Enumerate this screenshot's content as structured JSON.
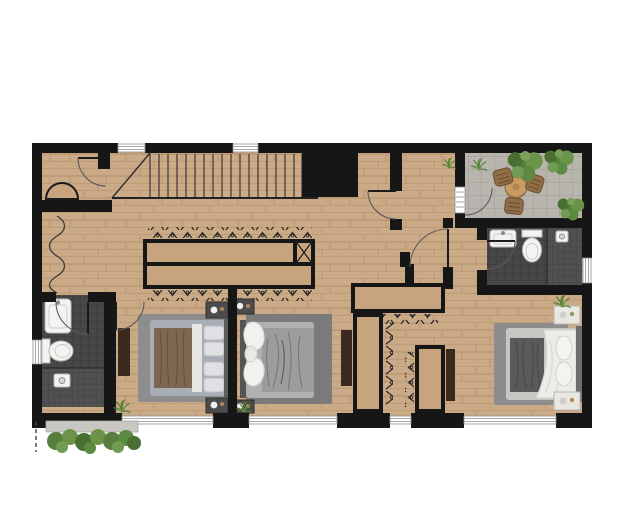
{
  "meta": {
    "title": "upper-floor-architectural-plan",
    "canvas": {
      "width": 623,
      "height": 532
    },
    "visible_text": []
  },
  "palette": {
    "wall": "#161616",
    "wood_floor": "#cbaa87",
    "wood_line": "#bb9671",
    "wardrobe_wood": "#c8a47e",
    "terrace_tile": "#b7b5ae",
    "bath_tile": "#474747",
    "shower_tile": "#515151",
    "rug": "#8d8d8d",
    "rug_mid": "#7b7b7b",
    "dresser": "#3b2a1d",
    "bed_brown": "#7c6750",
    "bed_gray": "#9c9c9c",
    "linen_white": "#edece8",
    "plant_green": "#4e7d33",
    "outside_ledge": "#c9c7c2",
    "window_frame": "#8f8f8f",
    "table_wood": "#c99b62",
    "chair_wicker": "#8f6d46"
  },
  "rooms": [
    {
      "name": "stair-hall",
      "features": [
        "staircase-18-treads",
        "storage-closet-top-left",
        "hanging-closet-wavy-symbol"
      ]
    },
    {
      "name": "hallway",
      "features": [
        "double-sided-wardrobe-with-hangers",
        "shaft-x-square"
      ]
    },
    {
      "name": "terrace",
      "features": [
        "round-table",
        "three-wicker-chairs",
        "corner-bushes",
        "stone-tile-floor",
        "glass-door"
      ]
    },
    {
      "name": "bathroom-ensuite-top-right",
      "fixtures": [
        "vanity-sink",
        "toilet",
        "shower"
      ],
      "features": [
        "window-right-wall"
      ]
    },
    {
      "name": "bathroom-left",
      "fixtures": [
        "vanity-sink",
        "toilet",
        "shower"
      ],
      "features": [
        "window-left-wall"
      ]
    },
    {
      "name": "bedroom-left",
      "furniture": [
        "double-bed-brown-blanket",
        "two-nightstands",
        "dresser",
        "area-rug"
      ]
    },
    {
      "name": "bedroom-middle",
      "furniture": [
        "double-bed-gray-blanket",
        "two-nightstands",
        "dresser",
        "area-rug"
      ]
    },
    {
      "name": "bedroom-right",
      "furniture": [
        "double-bed-white-duvet",
        "two-nightstands",
        "walk-in-closet-two-wardrobes",
        "dresser",
        "area-rug",
        "potted-plant"
      ]
    }
  ],
  "stairs": {
    "treads": 18,
    "location": "along-top-wall",
    "start": "diagonal-cut-left"
  },
  "counts": {
    "bedrooms": 3,
    "bathrooms": 2,
    "door_arcs": 7,
    "windows": 8,
    "wardrobe_runs": 4,
    "plants": 9,
    "beds": 3,
    "nightstands": 6,
    "toilets": 2,
    "sinks": 2,
    "showers": 2,
    "terrace_chairs": 3
  }
}
